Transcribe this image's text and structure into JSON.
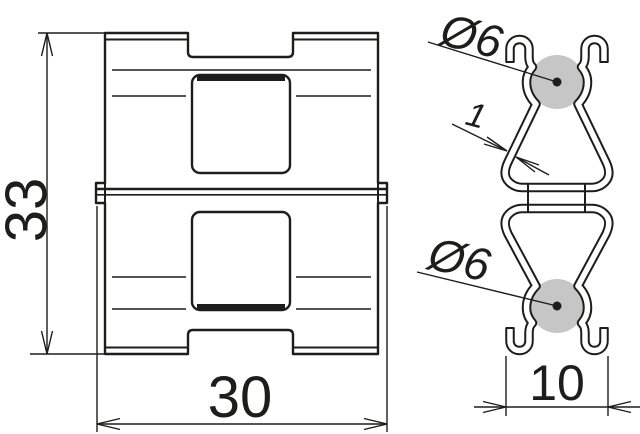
{
  "dimensions": {
    "overall_height": "33",
    "overall_width": "30",
    "clamp_base_width": "10",
    "top_conductor_diameter": "Ø6",
    "bottom_conductor_diameter": "Ø6",
    "material_thickness": "1"
  },
  "colors": {
    "line": "#1d1d1b",
    "conductor_fill": "#c6c6c6",
    "background": "#ffffff"
  }
}
